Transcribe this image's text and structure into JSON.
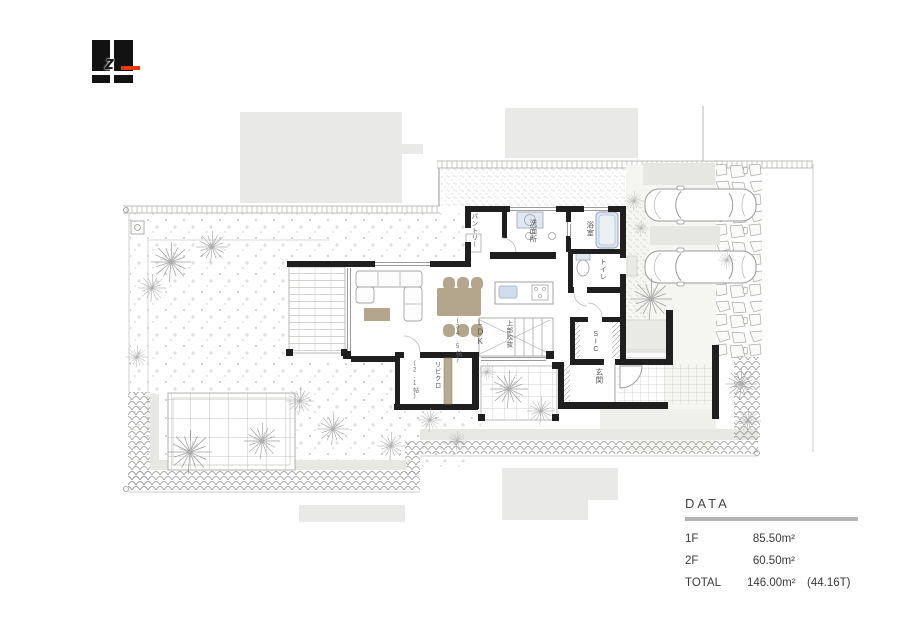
{
  "logo": {
    "letter": "z",
    "accent_color": "#e8380c",
    "block_color": "#121212"
  },
  "plan": {
    "rooms": {
      "pantry": "パントリー",
      "washroom": "洗面所",
      "bath": "浴室",
      "toilet": "トイレ",
      "ldk": "LDK",
      "ldk_size": "(34.5帖)",
      "void_above": "上部吹抜",
      "living_closet": "リビクロ",
      "living_closet_size": "(2.1帖)",
      "sic": "SIC",
      "entrance": "玄関"
    },
    "colors": {
      "wall": "#1f1f1f",
      "neighbor_building": "#e9e9e7",
      "furniture_tan": "#b3a68c",
      "water_blue": "#d6e2ef",
      "line_gray": "#9b9b9b"
    }
  },
  "data_panel": {
    "title": "DATA",
    "rows": [
      {
        "label": "1F",
        "value": "85.50m²",
        "note": ""
      },
      {
        "label": "2F",
        "value": "60.50m²",
        "note": ""
      },
      {
        "label": "TOTAL",
        "value": "146.00m²",
        "note": "(44.16T)"
      }
    ]
  }
}
